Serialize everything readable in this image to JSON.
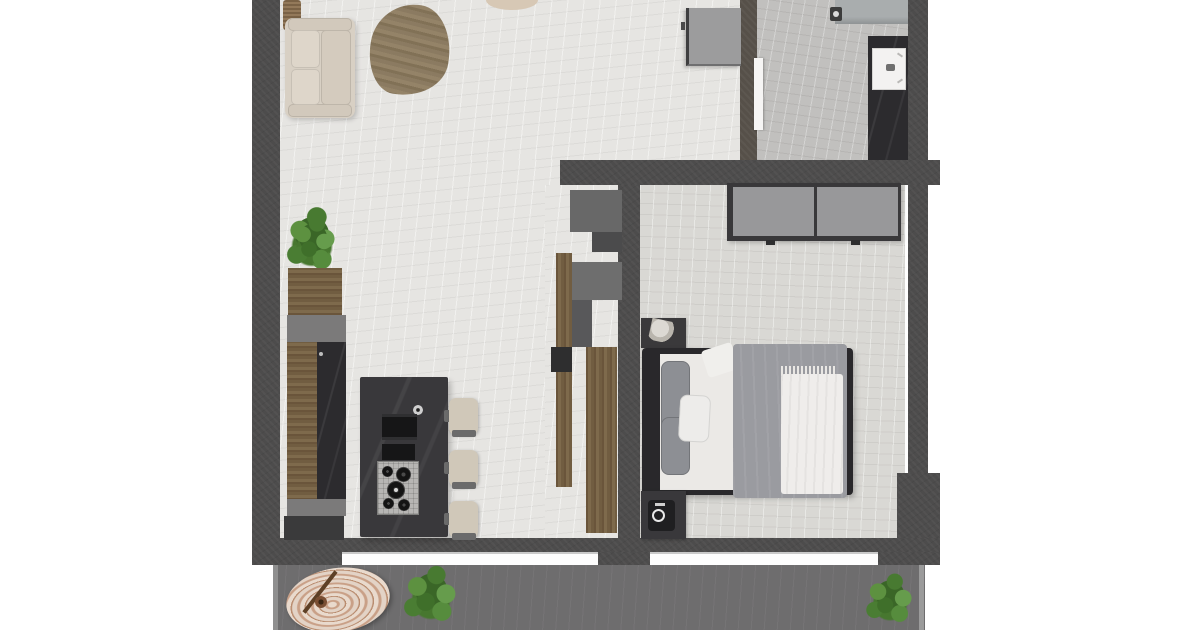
{
  "meta": {
    "title": "Top-down 3D apartment floor plan render",
    "image_type": "floor-plan-render",
    "background": "#ffffff"
  },
  "palette": {
    "wall": "#4d4c4c",
    "wall_entry": "#565049",
    "living_floor": "#e6e5e2",
    "bedroom_floor": "#d9d8d4",
    "bathroom_floor": "#c1c0be",
    "balcony_floor": "#6e6d6e",
    "wood": "#7e6a4c",
    "island_counter": "#39383b",
    "sofa": "#d8d0c4",
    "bar_stool": "#d0c8b9",
    "wardrobe_door": "#98989a",
    "bed_frame": "#29282b",
    "duvet_gray": "#9a9ba0",
    "linen_white": "#edecea",
    "plant_green": "#4a7d33",
    "parasol_cream": "#e9dacd",
    "washbasin_white": "#f3f2f1",
    "vanity_black": "#2c2b2e",
    "window_white": "#fdfdfd"
  },
  "counts": {
    "rooms_visible": 5,
    "bar_stools": 3,
    "hob_burners": 5,
    "windows": 2,
    "plants": 3,
    "nightstands": 2,
    "wardrobe_doors": 2
  },
  "rooms": {
    "living_room": {
      "name": "living-room",
      "furniture": [
        "sofa",
        "back-cushions",
        "wicker-basket",
        "hide-area-rug",
        "table-edge-at-top"
      ]
    },
    "kitchen": {
      "name": "kitchen",
      "furniture": [
        "wall-counter-run",
        "planter-with-plant",
        "island-with-gas-hob",
        "sink-faucet",
        "bar-stools"
      ]
    },
    "bedroom": {
      "name": "bedroom",
      "furniture": [
        "double-wardrobe",
        "double-bed",
        "gray-pillows",
        "white-pillow",
        "gray-duvet",
        "white-throw-blanket",
        "nightstand-upper",
        "nightstand-lower",
        "round-speaker"
      ]
    },
    "bathroom": {
      "name": "bathroom",
      "furniture": [
        "shower-screen",
        "shower-head",
        "black-vanity-counter",
        "white-washbasin",
        "door-leaf"
      ]
    },
    "hallway": {
      "name": "hallway",
      "furniture": [
        "storage-cabinet"
      ]
    },
    "balcony": {
      "name": "balcony",
      "furniture": [
        "parasol-top",
        "parasol-pole",
        "potted-plant-left",
        "potted-plant-right"
      ]
    }
  }
}
